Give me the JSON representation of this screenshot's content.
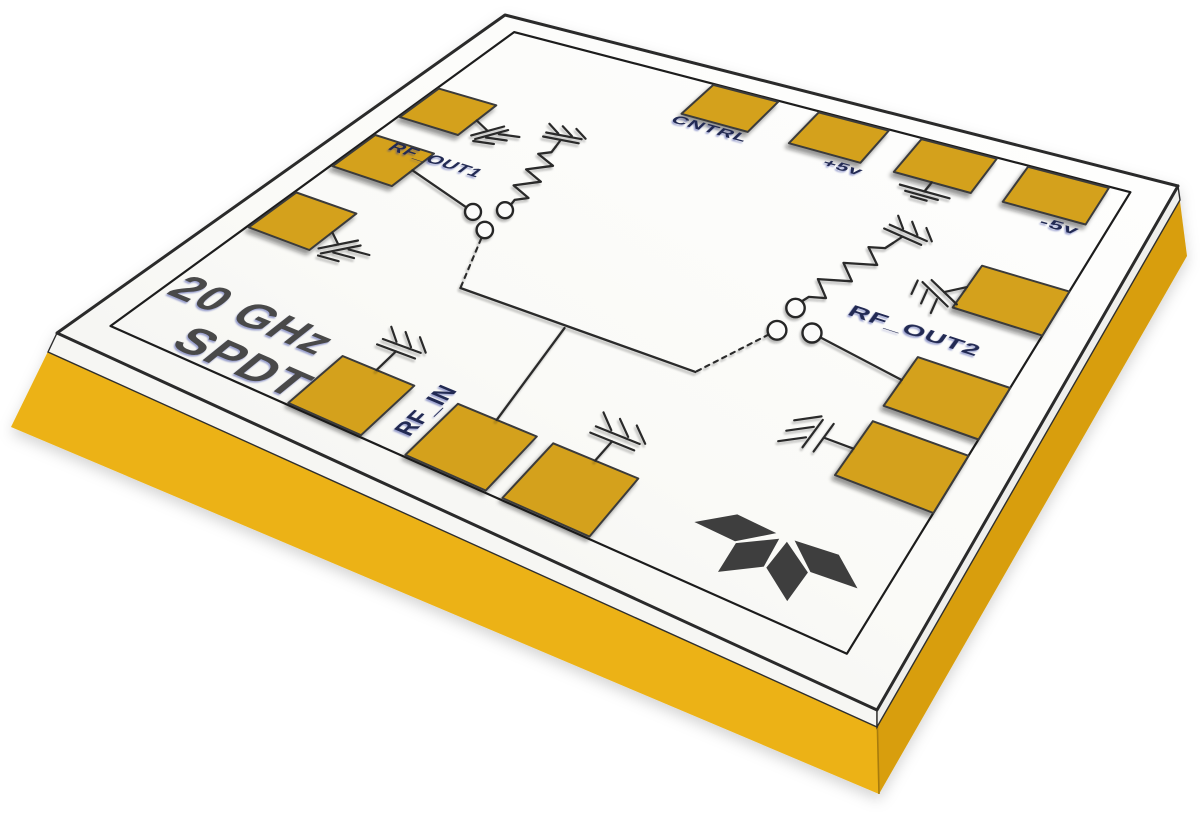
{
  "die": {
    "title_line1": "20 GHz",
    "title_line2": "SPDT",
    "port_labels": {
      "rf_out1": "RF_OUT1",
      "rf_out2": "RF_OUT2",
      "rf_in": "RF_IN",
      "cntrl": "CNTRL",
      "plus5v": "+5v",
      "minus5v": "-5v"
    },
    "logo_icon": "four-petal-fan-logo"
  },
  "colors": {
    "background": "#ffffff",
    "top_surface": "#fbfbfa",
    "pad_gold": "#d4a11b",
    "side_gold_front": "#ecb215",
    "side_gold_right": "#d89e0e",
    "rim_white": "#f6f6f3",
    "trace_ink": "#2b2b2b",
    "port_label_ink": "#232a52",
    "title_ink": "#4a4a4a",
    "logo_ink": "#3e3e3e",
    "outline_ink": "#2b2b2b",
    "crease_gold": "#a87c08"
  }
}
